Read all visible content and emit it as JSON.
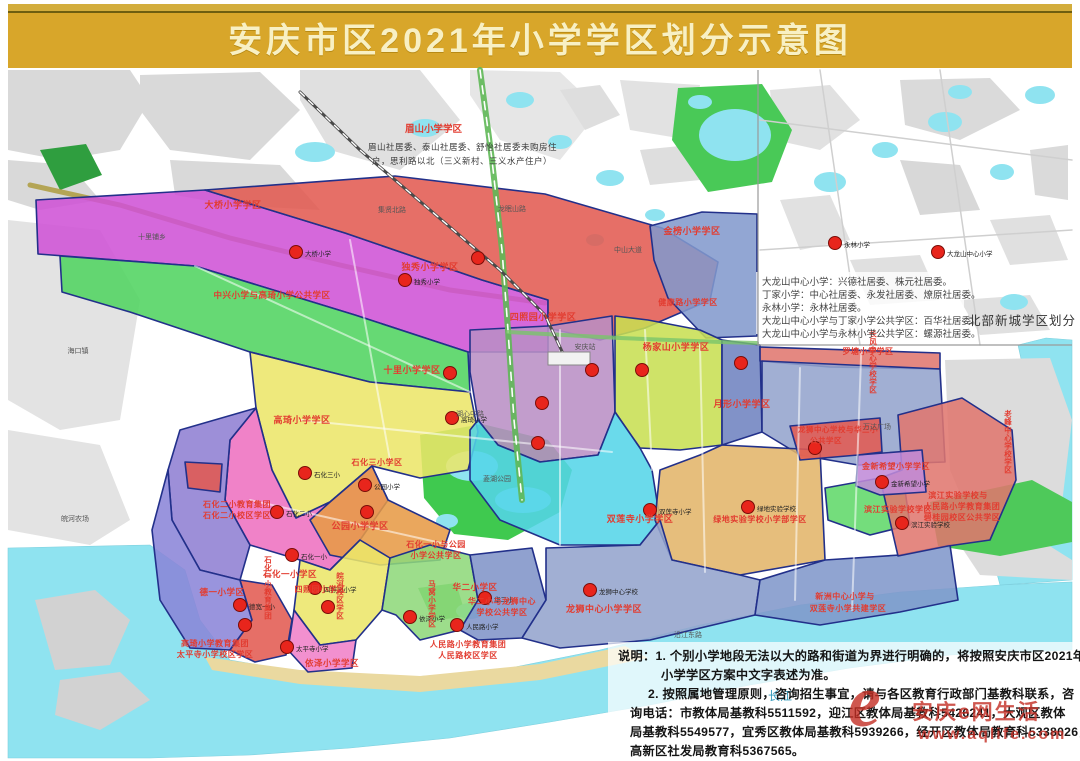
{
  "title": "安庆市区2021年小学学区划分示意图",
  "colors": {
    "band": "#d8a62a",
    "title_text": "#f8f0c4",
    "label_red": "#e23c30",
    "border_navy": "#22308a",
    "water": "#8fe3f0",
    "dot": "#e8251c"
  },
  "meishan": {
    "title": "眉山小学学区",
    "line1": "眉山社居委、泰山社居委、舒怡社居委未购房住",
    "line2": "户，思利路以北（三义新村、三义水产住户）"
  },
  "inset": {
    "caption": "北部新城学区划分",
    "notes": [
      "大龙山中心小学：兴德社居委、株元社居委。",
      "丁家小学：中心社居委、永发社居委、燎原社居委。",
      "永林小学：永林社居委。",
      "大龙山中心小学与丁家小学公共学区：百华社居委。",
      "大龙山中心小学与永林小学公共学区：螺源社居委。"
    ]
  },
  "notes": {
    "lines": [
      "说明：1. 个别小学地段无法以大的路和街道为界进行明确的，将按照安庆市区2021年",
      "小学学区方案中文字表述为准。",
      "2. 按照属地管理原则，咨询招生事宜，请与各区教育行政部门基教科联系，咨",
      "询电话：市教体局基教科5511592，迎江区教体局基教科5426241，大观区教体",
      "局基教科5549577，宜秀区教体局基教科5939266，经开区教体局教育科5338026，",
      "高新区社发局教育科5367565。"
    ]
  },
  "watermark": {
    "logo": "e",
    "brand": "安庆e网生活",
    "url": "www.aqlife.com"
  },
  "map": {
    "waters": [
      {
        "pts": "8,548 150,545 185,570 200,620 230,660 300,672 400,678 500,670 600,650 700,625 800,605 900,592 1000,585 1072,582 1072,650 950,655 850,668 750,685 650,705 550,722 450,738 350,748 250,755 150,758 8,758"
      },
      {
        "pts": "1018,345 1046,338 1072,340 1072,580 1000,585 988,540 1012,470 1030,400"
      }
    ],
    "lakes": [
      [
        315,
        152,
        20,
        10
      ],
      [
        425,
        128,
        16,
        9
      ],
      [
        520,
        100,
        14,
        8
      ],
      [
        560,
        142,
        12,
        7
      ],
      [
        610,
        178,
        14,
        8
      ],
      [
        700,
        102,
        12,
        7
      ],
      [
        735,
        135,
        36,
        26
      ],
      [
        655,
        215,
        10,
        6
      ],
      [
        595,
        240,
        9,
        6
      ],
      [
        830,
        182,
        16,
        10
      ],
      [
        885,
        150,
        13,
        8
      ],
      [
        945,
        122,
        17,
        10
      ],
      [
        1002,
        172,
        12,
        8
      ],
      [
        1014,
        302,
        14,
        8
      ],
      [
        960,
        92,
        12,
        7
      ],
      [
        1040,
        95,
        15,
        9
      ],
      [
        472,
        466,
        26,
        15
      ],
      [
        523,
        500,
        28,
        13
      ],
      [
        447,
        521,
        11,
        7
      ],
      [
        470,
        611,
        14,
        8
      ]
    ],
    "grays": [
      {
        "pts": "8,70 130,70 150,100 120,150 60,160 8,150"
      },
      {
        "pts": "140,75 260,72 300,110 250,160 170,150 140,110"
      },
      {
        "pts": "8,160 70,165 100,200 40,210 8,200"
      },
      {
        "pts": "170,160 280,165 320,210 230,205 175,195"
      },
      {
        "pts": "300,70 420,70 460,120 400,170 330,150 300,100",
        "c": "#e0e0e0"
      },
      {
        "pts": "470,70 560,72 600,110 560,160 500,140 470,95",
        "c": "#e6e6e6"
      },
      {
        "pts": "620,80 700,85 690,140 630,130",
        "c": "#e2e2e2"
      },
      {
        "pts": "8,220 100,230 140,300 120,420 60,430 8,400",
        "c": "#e3e3e3"
      },
      {
        "pts": "8,430 100,445 130,520 90,545 8,530",
        "c": "#e3e3e3"
      },
      {
        "pts": "945,360 1050,358 1072,420 1060,520 980,540 950,470",
        "c": "#dcdcdc"
      },
      {
        "pts": "960,545 1040,540 1072,560 1072,580 980,575",
        "c": "#dcdcdc"
      },
      {
        "pts": "35,600 95,590 130,620 110,665 55,670",
        "c": "#d2d2d2"
      },
      {
        "pts": "60,680 120,672 150,700 100,730 55,715",
        "c": "#d2d2d2"
      },
      {
        "pts": "560,90 600,85 620,115 585,130",
        "c": "#dedede"
      },
      {
        "pts": "640,150 690,145 700,180 650,185",
        "c": "#dedede"
      },
      {
        "pts": "770,90 830,85 860,120 820,150 775,140",
        "c": "#e1e1e1"
      },
      {
        "pts": "900,80 990,78 1020,110 960,140 905,125",
        "c": "#dadada"
      },
      {
        "pts": "1030,150 1068,145 1068,200 1035,195",
        "c": "#dadada"
      },
      {
        "pts": "780,200 830,195 850,240 800,250",
        "c": "#e1e1e1"
      },
      {
        "pts": "900,160 960,165 980,210 920,215",
        "c": "#d8d8d8"
      },
      {
        "pts": "990,220 1050,215 1068,260 1010,265",
        "c": "#e0e0e0"
      },
      {
        "pts": "850,260 920,255 940,300 870,305",
        "c": "#e0e0e0"
      },
      {
        "pts": "960,300 1030,295 1050,330 980,335",
        "c": "#e0e0e0"
      }
    ],
    "parks": [
      {
        "pts": "420,435 482,424 548,440 572,470 560,512 508,540 454,534 424,498",
        "c": "#3fc94f"
      },
      {
        "pts": "678,88 762,84 792,130 772,182 708,192 672,140",
        "c": "#49c957"
      },
      {
        "pts": "930,502 1032,480 1072,502 1072,542 1000,556 938,546",
        "c": "#4ec95a"
      },
      {
        "pts": "40,150 86,144 102,175 60,190",
        "c": "#2f9e3f"
      },
      {
        "pts": "418,588 456,583 466,616 433,621",
        "c": "#49c957"
      }
    ],
    "beach": "205,657 300,670 420,676 540,664 625,646 648,658 540,680 420,692 300,684 212,670",
    "roads_under": [
      {
        "pts": "30,185 120,205 230,238 340,265 450,290 545,303",
        "w": 5,
        "c": "#ad9b3d",
        "o": 0.85
      },
      {
        "pts": "760,120 1072,160",
        "w": 1.5,
        "c": "#cfcfcf"
      },
      {
        "pts": "820,70 860,345",
        "w": 1.5,
        "c": "#cfcfcf"
      },
      {
        "pts": "760,250 1072,230",
        "w": 1.5,
        "c": "#cfcfcf"
      },
      {
        "pts": "940,70 980,345",
        "w": 1.5,
        "c": "#cfcfcf"
      }
    ],
    "roads_over": [
      {
        "pts": "480,70 492,160 502,250 508,330 514,420 522,500",
        "w": 6,
        "c": "#5fb857",
        "o": 0.9
      },
      {
        "pts": "480,70 492,160 502,250 508,330 514,420 522,500",
        "w": 1.6,
        "c": "#ffffff",
        "dash": "8,8"
      },
      {
        "pts": "508,332 620,338 720,342 757,343",
        "w": 4,
        "c": "#79c46a",
        "o": 0.8
      },
      {
        "pts": "195,266 470,392",
        "w": 2,
        "c": "#ffffff",
        "o": 0.55
      },
      {
        "pts": "300,420 612,452",
        "w": 2,
        "c": "#ffffff",
        "o": 0.55
      },
      {
        "pts": "250,500 450,545",
        "w": 2,
        "c": "#ffffff",
        "o": 0.55
      },
      {
        "pts": "560,330 560,545",
        "w": 2,
        "c": "#ffffff",
        "o": 0.55
      },
      {
        "pts": "700,345 705,572",
        "w": 2,
        "c": "#ffffff",
        "o": 0.55
      },
      {
        "pts": "800,368 795,600",
        "w": 2,
        "c": "#ffffff",
        "o": 0.55
      },
      {
        "pts": "862,330 852,610",
        "w": 2,
        "c": "#ffffff",
        "o": 0.55
      },
      {
        "pts": "350,240 390,460",
        "w": 2,
        "c": "#ffffff",
        "o": 0.55
      },
      {
        "pts": "645,330 652,470",
        "w": 2,
        "c": "#ffffff",
        "o": 0.55
      }
    ],
    "railway": "300,92 360,150 430,210 500,270 545,315 566,360",
    "station": {
      "x": 548,
      "y": 352,
      "w": 42,
      "h": 13
    },
    "regions": [
      {
        "name": "daqiao",
        "fill": "#cf52d6",
        "pts": "36,200 205,190 345,233 482,280 548,300 548,352 468,352 355,315 195,266 38,254"
      },
      {
        "name": "zhongxing-gaoqi",
        "fill": "#4fd35f",
        "pts": "60,256 195,266 355,315 468,352 470,392 370,382 250,352 130,312 62,292"
      },
      {
        "name": "duxiu",
        "fill": "#e25a50",
        "pts": "205,190 395,176 545,194 662,228 718,262 710,300 645,328 600,340 548,328 548,300 482,280 345,233"
      },
      {
        "name": "jinbang",
        "fill": "#8299cd",
        "pts": "650,226 702,212 757,214 757,336 706,338 668,298 654,260"
      },
      {
        "name": "yellow-west",
        "fill": "#ece668",
        "pts": "250,352 370,382 470,392 478,432 468,470 420,478 372,466 330,502 296,518 272,470 256,408"
      },
      {
        "name": "mauve-center",
        "fill": "#b98fc4",
        "pts": "470,330 548,326 612,316 615,412 598,455 540,462 498,445 478,420 470,372"
      },
      {
        "name": "yangjiashan",
        "fill": "#c8df52",
        "pts": "615,316 648,320 700,330 722,340 722,445 680,450 640,448 615,412"
      },
      {
        "name": "darkblue-strip",
        "fill": "#6e82c0",
        "pts": "722,340 760,345 762,432 722,445"
      },
      {
        "name": "luotang",
        "fill": "#e0766e",
        "pts": "760,347 940,353 940,369 830,367 760,361"
      },
      {
        "name": "yuexing",
        "fill": "#93a3cd",
        "pts": "762,361 940,369 945,462 858,465 800,455 762,432"
      },
      {
        "name": "shuanglian",
        "fill": "#54d5e8",
        "pts": "470,430 478,420 498,445 540,462 598,455 615,412 640,448 652,470 660,520 640,545 560,545 500,520 470,480"
      },
      {
        "name": "lvdi",
        "fill": "#e2b468",
        "pts": "660,470 700,455 722,445 820,450 825,560 740,575 672,560 655,520"
      },
      {
        "name": "shihua-yi",
        "fill": "#ee6fc0",
        "pts": "256,408 272,470 296,518 330,502 372,466 388,500 360,540 330,570 300,560 250,545 225,500 230,440"
      },
      {
        "name": "shihua-er",
        "fill": "#8f7ed2",
        "pts": "180,430 256,408 230,440 225,500 250,545 240,580 200,570 172,520 168,470"
      },
      {
        "name": "gongyuan",
        "fill": "#e79a45",
        "pts": "310,520 330,502 372,466 388,500 450,530 440,560 380,565 330,555"
      },
      {
        "name": "deyi",
        "fill": "#8a84d8",
        "pts": "168,470 172,520 200,570 240,580 252,620 230,650 190,648 160,600 152,530"
      },
      {
        "name": "taipingsi",
        "fill": "#e25a50",
        "pts": "230,650 252,620 240,580 272,585 292,620 286,655 255,662"
      },
      {
        "name": "sizhaoyuan",
        "fill": "#ece668",
        "pts": "300,560 330,570 360,540 390,558 382,610 356,640 320,645 294,610"
      },
      {
        "name": "yize",
        "fill": "#f07fc8",
        "pts": "294,610 320,645 356,640 352,668 308,672 288,650"
      },
      {
        "name": "huaer",
        "fill": "#8ed87a",
        "pts": "390,558 430,545 470,555 478,600 460,630 420,640 396,615 382,610"
      },
      {
        "name": "huayi",
        "fill": "#7f93c8",
        "pts": "470,555 532,548 546,600 522,638 478,640 460,630 478,600"
      },
      {
        "name": "longshi-big",
        "fill": "#93a3cd",
        "pts": "546,548 640,545 660,520 672,560 740,575 760,580 755,615 650,640 560,648 522,638 546,600"
      },
      {
        "name": "xinzhou",
        "fill": "#8096ca",
        "pts": "760,580 825,560 900,555 950,545 958,600 900,612 820,625 755,615"
      },
      {
        "name": "binjiang-green",
        "fill": "#5fd868",
        "pts": "825,488 880,478 905,490 910,525 870,535 828,520"
      },
      {
        "name": "binjiang-renmin",
        "fill": "#e0766e",
        "pts": "898,415 962,398 1012,430 1016,480 990,540 948,546 898,556 880,478 902,470"
      },
      {
        "name": "jinxin",
        "fill": "#c08ad8",
        "pts": "858,455 922,450 926,492 880,495 856,486"
      },
      {
        "name": "longshi-red-small",
        "fill": "#e25a50",
        "pts": "790,426 880,418 882,452 858,455 800,460"
      },
      {
        "name": "small-red-west",
        "fill": "#e25a50",
        "pts": "185,462 222,464 220,492 188,488"
      }
    ],
    "overlays": [
      {
        "x": 608,
        "y": 642,
        "w": 466,
        "h": 112,
        "o": 0.72
      },
      {
        "x": 756,
        "y": 272,
        "w": 208,
        "h": 62,
        "o": 0.8
      }
    ],
    "inset_border": "758,70 758,345 1072,345",
    "dots": [
      {
        "x": 296,
        "y": 252,
        "l": "大桥小学"
      },
      {
        "x": 478,
        "y": 258
      },
      {
        "x": 405,
        "y": 280,
        "l": "独秀小学"
      },
      {
        "x": 450,
        "y": 373
      },
      {
        "x": 452,
        "y": 418,
        "l": "高琦小学"
      },
      {
        "x": 542,
        "y": 403
      },
      {
        "x": 538,
        "y": 443
      },
      {
        "x": 592,
        "y": 370
      },
      {
        "x": 642,
        "y": 370
      },
      {
        "x": 741,
        "y": 363
      },
      {
        "x": 650,
        "y": 510,
        "l": "双莲寺小学"
      },
      {
        "x": 748,
        "y": 507,
        "l": "绿地实验学校"
      },
      {
        "x": 815,
        "y": 448
      },
      {
        "x": 882,
        "y": 482,
        "l": "金新希望小学"
      },
      {
        "x": 902,
        "y": 523,
        "l": "滨江实验学校"
      },
      {
        "x": 410,
        "y": 617,
        "l": "依泽小学"
      },
      {
        "x": 457,
        "y": 625,
        "l": "人民路小学"
      },
      {
        "x": 485,
        "y": 598,
        "l": "华二小"
      },
      {
        "x": 590,
        "y": 590,
        "l": "龙狮中心学校"
      },
      {
        "x": 305,
        "y": 473,
        "l": "石化三小"
      },
      {
        "x": 365,
        "y": 485,
        "l": "公园小学"
      },
      {
        "x": 277,
        "y": 512,
        "l": "石化二小"
      },
      {
        "x": 367,
        "y": 512
      },
      {
        "x": 292,
        "y": 555,
        "l": "石化一小"
      },
      {
        "x": 315,
        "y": 588,
        "l": "四照园小学"
      },
      {
        "x": 328,
        "y": 607
      },
      {
        "x": 240,
        "y": 605,
        "l": "德宽一小"
      },
      {
        "x": 245,
        "y": 625
      },
      {
        "x": 287,
        "y": 647,
        "l": "太平寺小学"
      },
      {
        "x": 835,
        "y": 243,
        "l": "永林小学"
      },
      {
        "x": 938,
        "y": 252,
        "l": "大龙山中心小学"
      }
    ],
    "labels": [
      {
        "t": "大桥小学学区",
        "x": 233,
        "y": 208
      },
      {
        "t": "金榜小学学区",
        "x": 692,
        "y": 234
      },
      {
        "t": "独秀小学学区",
        "x": 430,
        "y": 270
      },
      {
        "t": "中兴小学与高琦小学公共学区",
        "x": 272,
        "y": 298,
        "fs": 8.5
      },
      {
        "t": "四照园小学学区",
        "x": 543,
        "y": 320
      },
      {
        "t": "健康路小学学区",
        "x": 688,
        "y": 305,
        "fs": 8
      },
      {
        "t": "杨家山小学学区",
        "x": 676,
        "y": 350
      },
      {
        "t": "罗塘小学学区",
        "x": 868,
        "y": 354,
        "fs": 8
      },
      {
        "t": "十里小学学区",
        "x": 412,
        "y": 373
      },
      {
        "t": "月形小学学区",
        "x": 742,
        "y": 407
      },
      {
        "t": "高琦小学学区",
        "x": 302,
        "y": 423
      },
      {
        "t": "石化三小学区",
        "x": 377,
        "y": 465,
        "fs": 8
      },
      {
        "t": "石化二小教育集团",
        "x": 237,
        "y": 507,
        "fs": 8
      },
      {
        "t": "石化二小校区学区",
        "x": 237,
        "y": 518,
        "fs": 8
      },
      {
        "t": "公园小学学区",
        "x": 360,
        "y": 529
      },
      {
        "t": "石化一小与公园",
        "x": 436,
        "y": 547,
        "fs": 8
      },
      {
        "t": "小学公共学区",
        "x": 436,
        "y": 558,
        "fs": 8
      },
      {
        "t": "石化一小学区",
        "x": 290,
        "y": 577,
        "fs": 8.5
      },
      {
        "t": "德一小学区",
        "x": 222,
        "y": 595,
        "fs": 8.5
      },
      {
        "t": "四照园小学区",
        "x": 320,
        "y": 592,
        "fs": 8
      },
      {
        "t": "华二小学区",
        "x": 475,
        "y": 590,
        "fs": 8.5
      },
      {
        "t": "华二小与龙狮中心",
        "x": 502,
        "y": 604,
        "fs": 8
      },
      {
        "t": "学校公共学区",
        "x": 502,
        "y": 615,
        "fs": 8
      },
      {
        "t": "龙狮中心小学学区",
        "x": 604,
        "y": 612
      },
      {
        "t": "新洲中心小学与",
        "x": 845,
        "y": 599,
        "fs": 8
      },
      {
        "t": "双莲寺小学共建学区",
        "x": 848,
        "y": 611,
        "fs": 8
      },
      {
        "t": "双莲寺小学学区",
        "x": 640,
        "y": 522
      },
      {
        "t": "绿地实验学校小学部学区",
        "x": 760,
        "y": 522,
        "fs": 8
      },
      {
        "t": "龙狮中心学校与华三小",
        "x": 838,
        "y": 432,
        "fs": 7.5
      },
      {
        "t": "公共学区",
        "x": 826,
        "y": 443,
        "fs": 7.5
      },
      {
        "t": "金新希望小学学区",
        "x": 896,
        "y": 469,
        "fs": 8
      },
      {
        "t": "滨江实验学校学区",
        "x": 898,
        "y": 512,
        "fs": 8
      },
      {
        "t": "滨江实验学校与",
        "x": 958,
        "y": 498,
        "fs": 8
      },
      {
        "t": "人民路小学教育集团",
        "x": 962,
        "y": 509,
        "fs": 8
      },
      {
        "t": "碧桂园校区公共学区",
        "x": 962,
        "y": 520,
        "fs": 8
      },
      {
        "t": "人民路小学教育集团",
        "x": 468,
        "y": 647,
        "fs": 8
      },
      {
        "t": "人民路校区学区",
        "x": 468,
        "y": 658,
        "fs": 8
      },
      {
        "t": "高琦小学教育集团",
        "x": 215,
        "y": 646,
        "fs": 8
      },
      {
        "t": "太平寺小学校区学区",
        "x": 215,
        "y": 657,
        "fs": 8
      },
      {
        "t": "依泽小学学区",
        "x": 332,
        "y": 666,
        "fs": 8.5
      },
      {
        "t": "石化一小教育集团",
        "x": 268,
        "y": 588,
        "v": 1,
        "fs": 7.5
      },
      {
        "t": "皖河校区学区",
        "x": 340,
        "y": 596,
        "v": 1,
        "fs": 7.5
      },
      {
        "t": "马窝小学学区",
        "x": 432,
        "y": 604,
        "v": 1,
        "fs": 7.5
      },
      {
        "t": "长风中心学校学区",
        "x": 873,
        "y": 362,
        "v": 1,
        "fs": 7.5
      },
      {
        "t": "老峰中心学校学区",
        "x": 1008,
        "y": 442,
        "v": 1,
        "fs": 7.5
      }
    ],
    "places": [
      {
        "t": "安庆站",
        "x": 585,
        "y": 349
      },
      {
        "t": "菱湖公园",
        "x": 497,
        "y": 481
      },
      {
        "t": "万达广场",
        "x": 877,
        "y": 429
      },
      {
        "t": "长江",
        "x": 780,
        "y": 700,
        "fs": 12,
        "c": "#3399bb"
      },
      {
        "t": "沿江东路",
        "x": 688,
        "y": 637
      },
      {
        "t": "集贤北路",
        "x": 392,
        "y": 212
      },
      {
        "t": "中山大道",
        "x": 628,
        "y": 252
      },
      {
        "t": "湖心中路",
        "x": 470,
        "y": 416
      },
      {
        "t": "皖河农场",
        "x": 75,
        "y": 521
      },
      {
        "t": "海口镇",
        "x": 78,
        "y": 353
      },
      {
        "t": "十里铺乡",
        "x": 152,
        "y": 239
      },
      {
        "t": "龙眠山路",
        "x": 512,
        "y": 211
      }
    ]
  }
}
